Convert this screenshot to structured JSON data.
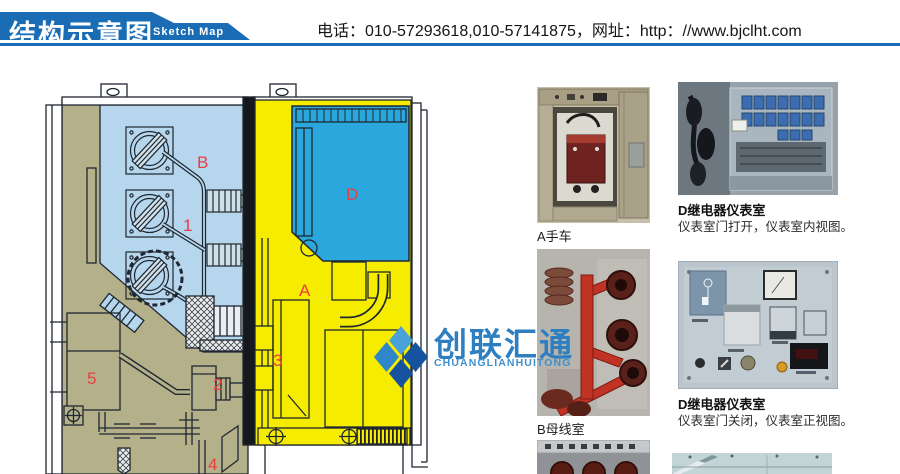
{
  "header": {
    "title": "结构示意图",
    "subtitle": "Sketch Map",
    "contact": "电话：010-57293618,010-57141875，网址：http：//www.bjclht.com"
  },
  "logo": {
    "name": "创联汇通",
    "name_en": "CHUANGLIANHUITONG"
  },
  "diagram": {
    "labels": [
      {
        "text": "B"
      },
      {
        "text": "1"
      },
      {
        "text": "D"
      },
      {
        "text": "A"
      },
      {
        "text": "3"
      },
      {
        "text": "2"
      },
      {
        "text": "5"
      },
      {
        "text": "4"
      }
    ],
    "colors": {
      "busbar_room": "#b5d6ec",
      "relay_room": "#2aa7dd",
      "breaker_room": "#f6ec00",
      "cable_room": "#b3b08a",
      "label": "#e84040",
      "header_blue": "#1a6cb5"
    }
  },
  "photos": {
    "a": {
      "caption": "A手车"
    },
    "d_open": {
      "caption": "D继电器仪表室",
      "desc": "仪表室门打开，仪表室内视图。"
    },
    "b": {
      "caption": "B母线室"
    },
    "d_closed": {
      "caption": "D继电器仪表室",
      "desc": "仪表室门关闭，仪表室正视图。"
    }
  }
}
